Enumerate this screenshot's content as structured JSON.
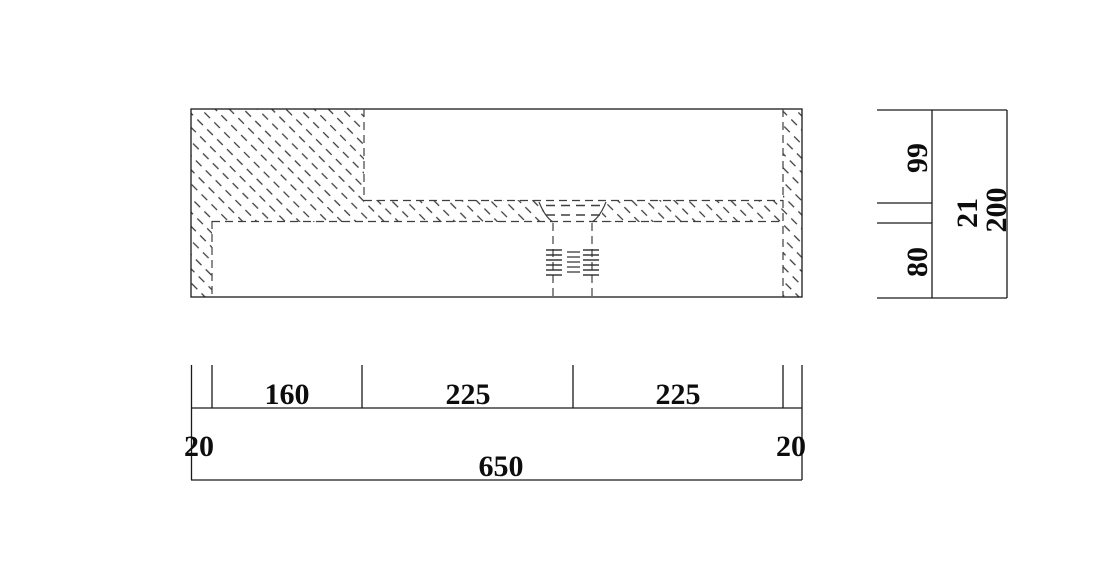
{
  "drawing": {
    "background": "#ffffff",
    "line_color": "#1a1a1a",
    "hidden_line_color": "#3f3f3f"
  },
  "dimensions": {
    "horizontal": {
      "edge_left": "20",
      "seg_160": "160",
      "seg_225_left": "225",
      "seg_225_right": "225",
      "edge_right": "20",
      "total": "650"
    },
    "vertical": {
      "top": "99",
      "middle": "21",
      "bottom": "80",
      "total": "200"
    }
  }
}
